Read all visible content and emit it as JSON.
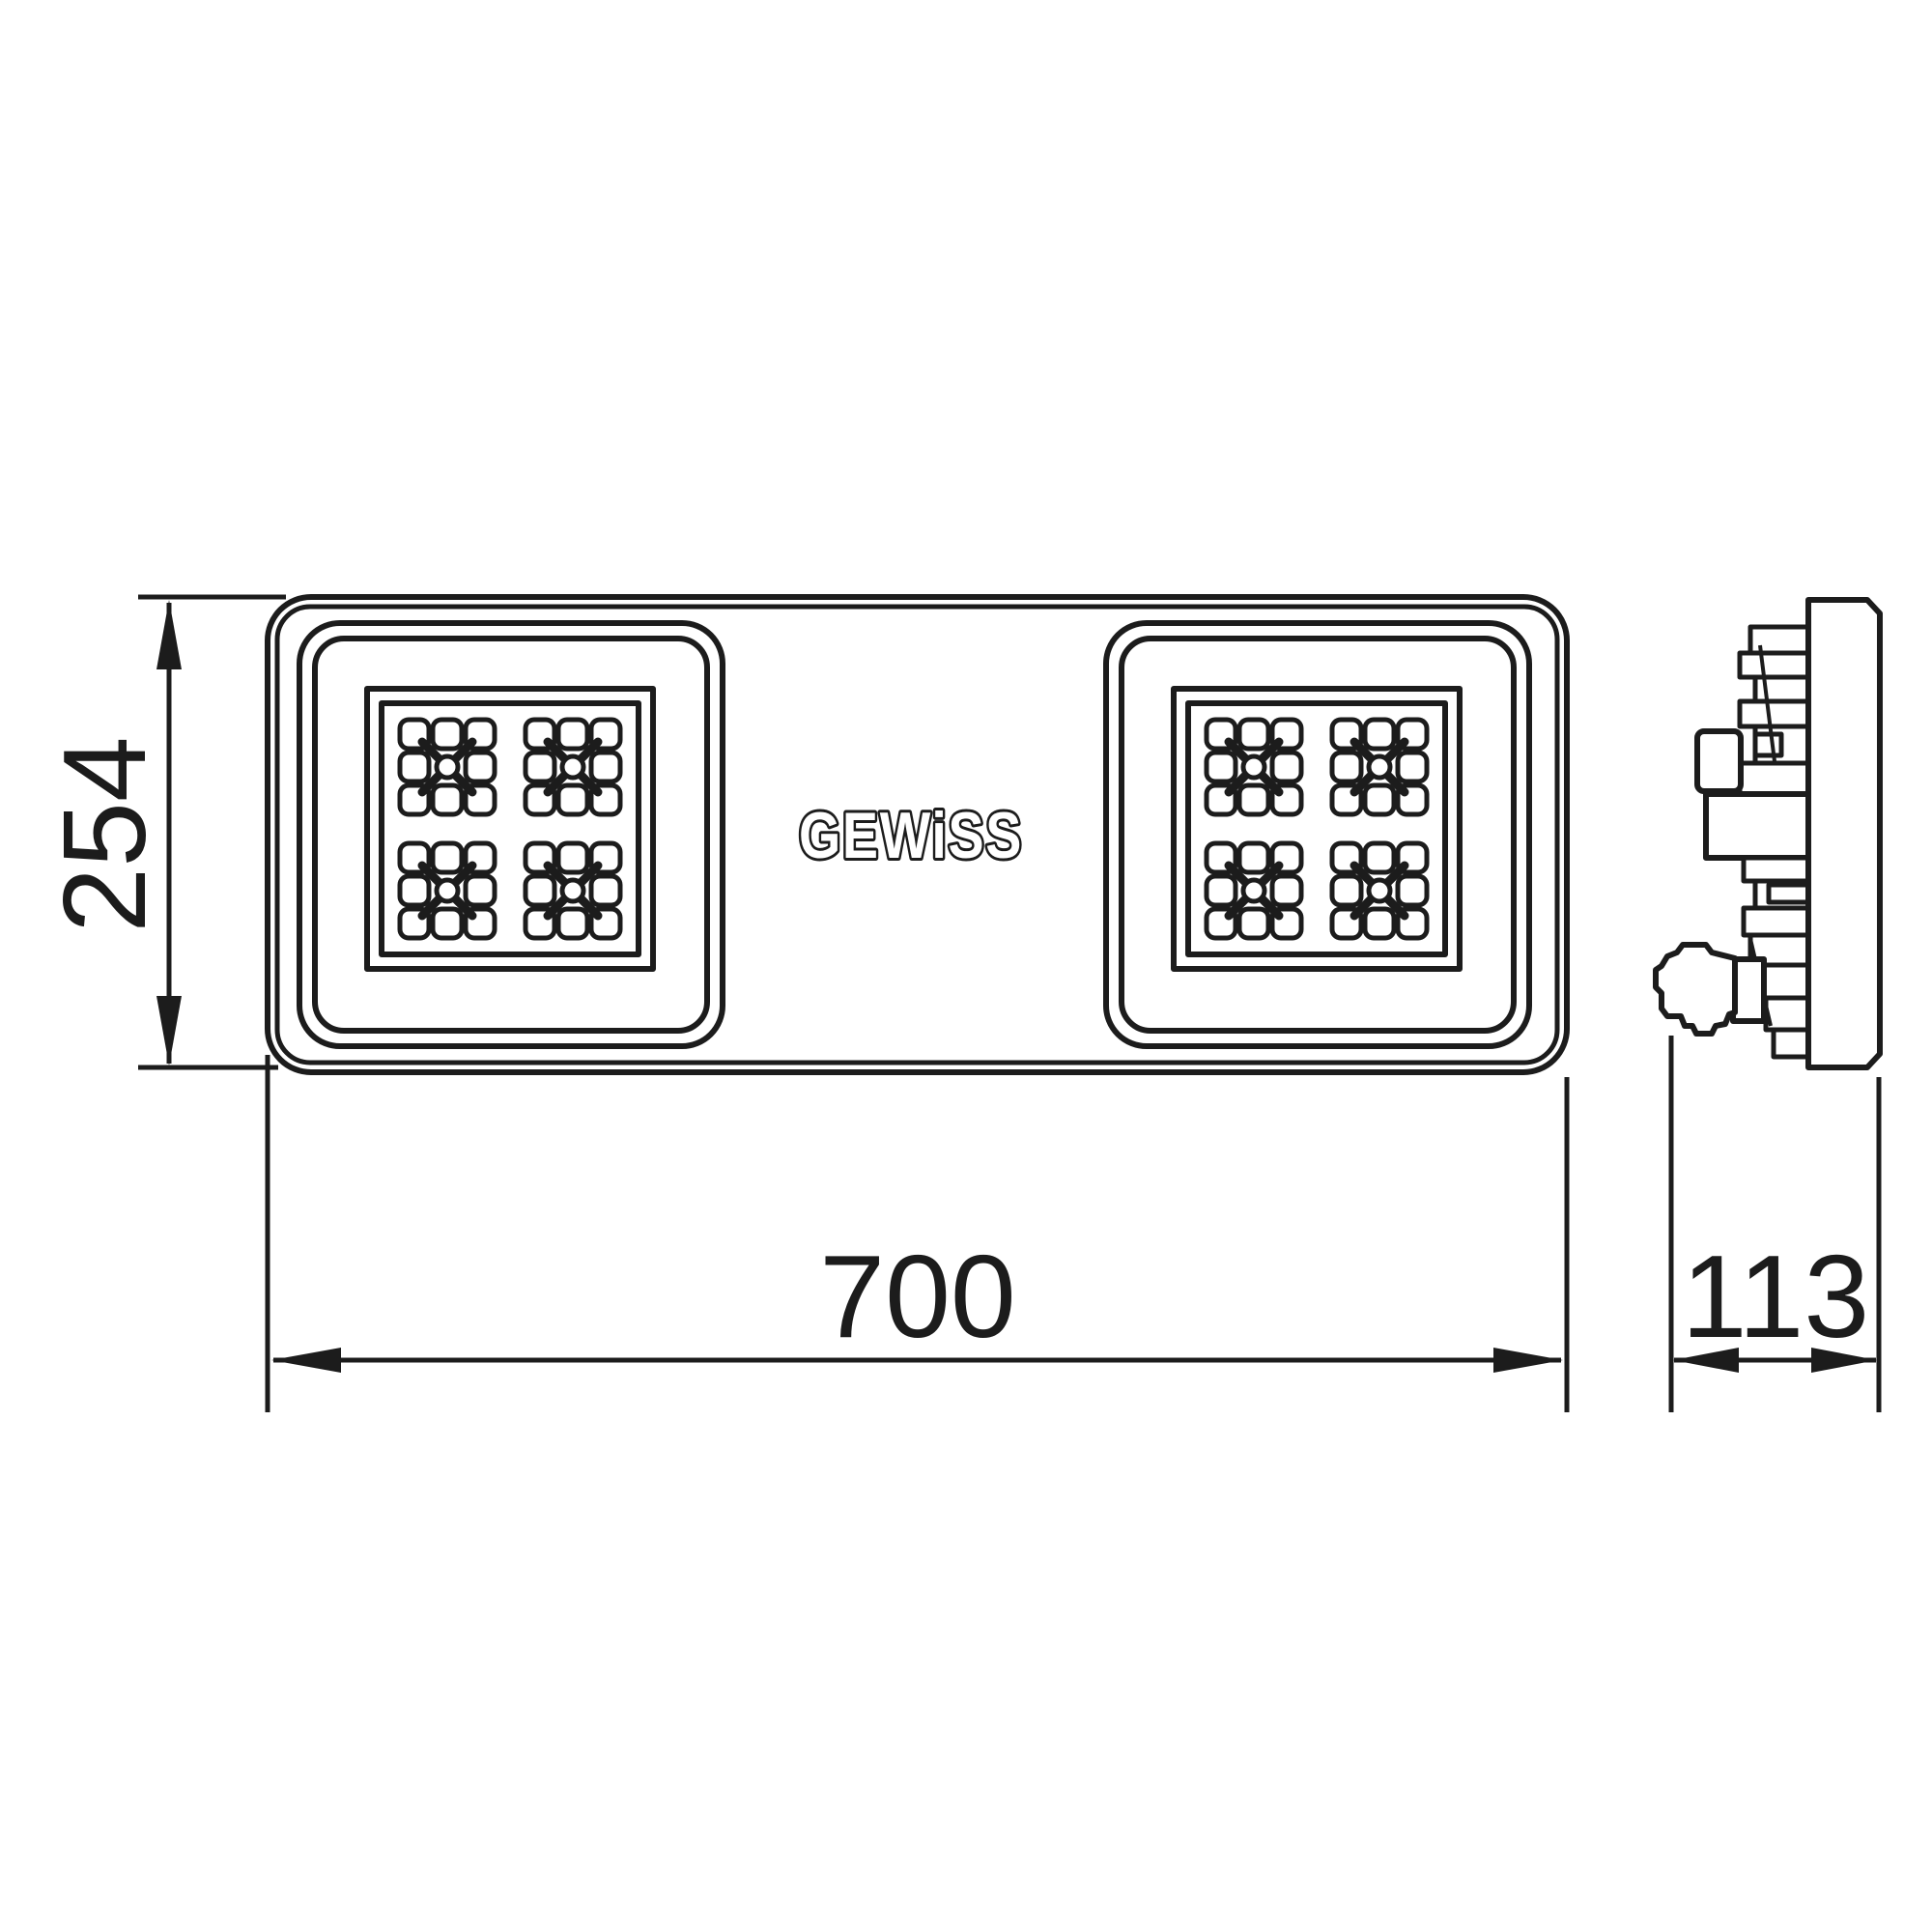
{
  "drawing": {
    "logo_text": "GEWiSS",
    "dimensions": {
      "height": "254",
      "width": "700",
      "depth": "113"
    }
  },
  "colors": {
    "line": "#1c1c1c",
    "background": "#ffffff"
  }
}
